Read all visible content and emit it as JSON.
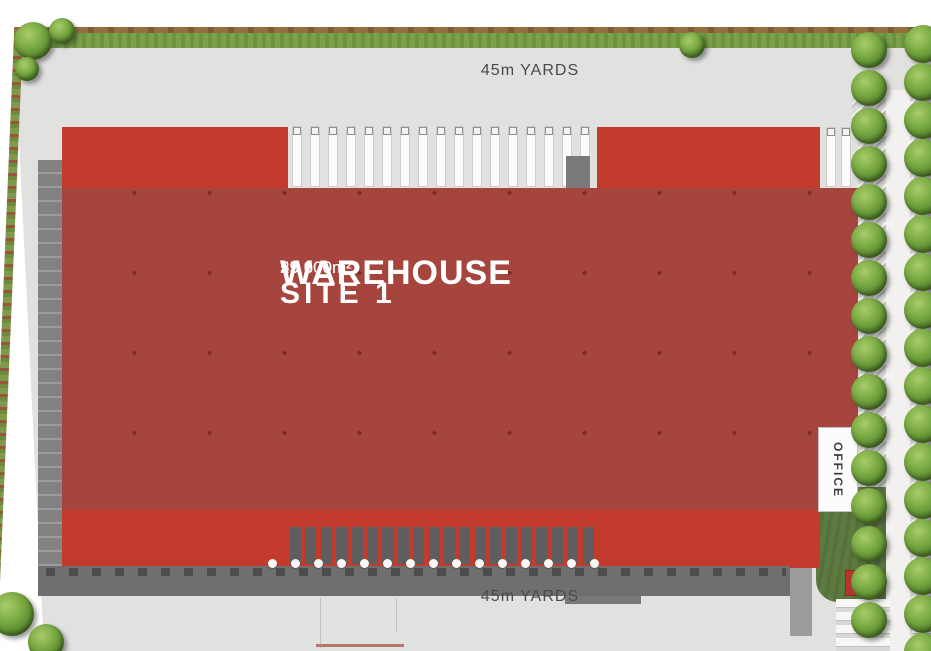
{
  "labels": {
    "yard_top": "45m YARDS",
    "yard_bottom": "45m YARDS",
    "warehouse_name": "WAREHOUSE",
    "warehouse_area": "25 600m²",
    "site_name": "SITE 1",
    "site_area": "59 900m²",
    "office": "OFFICE"
  },
  "colors": {
    "roof": "#a6453e",
    "canopy": "#c33b2d",
    "apron": "#6f6f6f",
    "dockside": "#828282",
    "yard": "#e1e1e0",
    "grass": "#7ba14b",
    "hedge": "#93713f",
    "lawn": "#5d7a40",
    "road": "#f2f1ef",
    "text_gray": "#4a4a4a",
    "text_white": "#ffffff"
  },
  "docks": {
    "top_door_count": 17,
    "top_right_door_count": 2,
    "bottom_tooth_count": 20,
    "bottom_bumper_count": 15
  },
  "landscape": {
    "tree_columns": [
      {
        "x": 869,
        "y_start": 50,
        "step": 38,
        "count": 16,
        "d": 36
      },
      {
        "x": 923,
        "y_start": 44,
        "step": 38,
        "count": 17,
        "d": 38
      }
    ],
    "trees": [
      {
        "x": 33,
        "y": 41,
        "d": 38
      },
      {
        "x": 62,
        "y": 31,
        "d": 26
      },
      {
        "x": 27,
        "y": 69,
        "d": 24
      },
      {
        "x": 692,
        "y": 45,
        "d": 26
      },
      {
        "x": 12,
        "y": 614,
        "d": 44
      },
      {
        "x": 46,
        "y": 642,
        "d": 36
      }
    ]
  }
}
